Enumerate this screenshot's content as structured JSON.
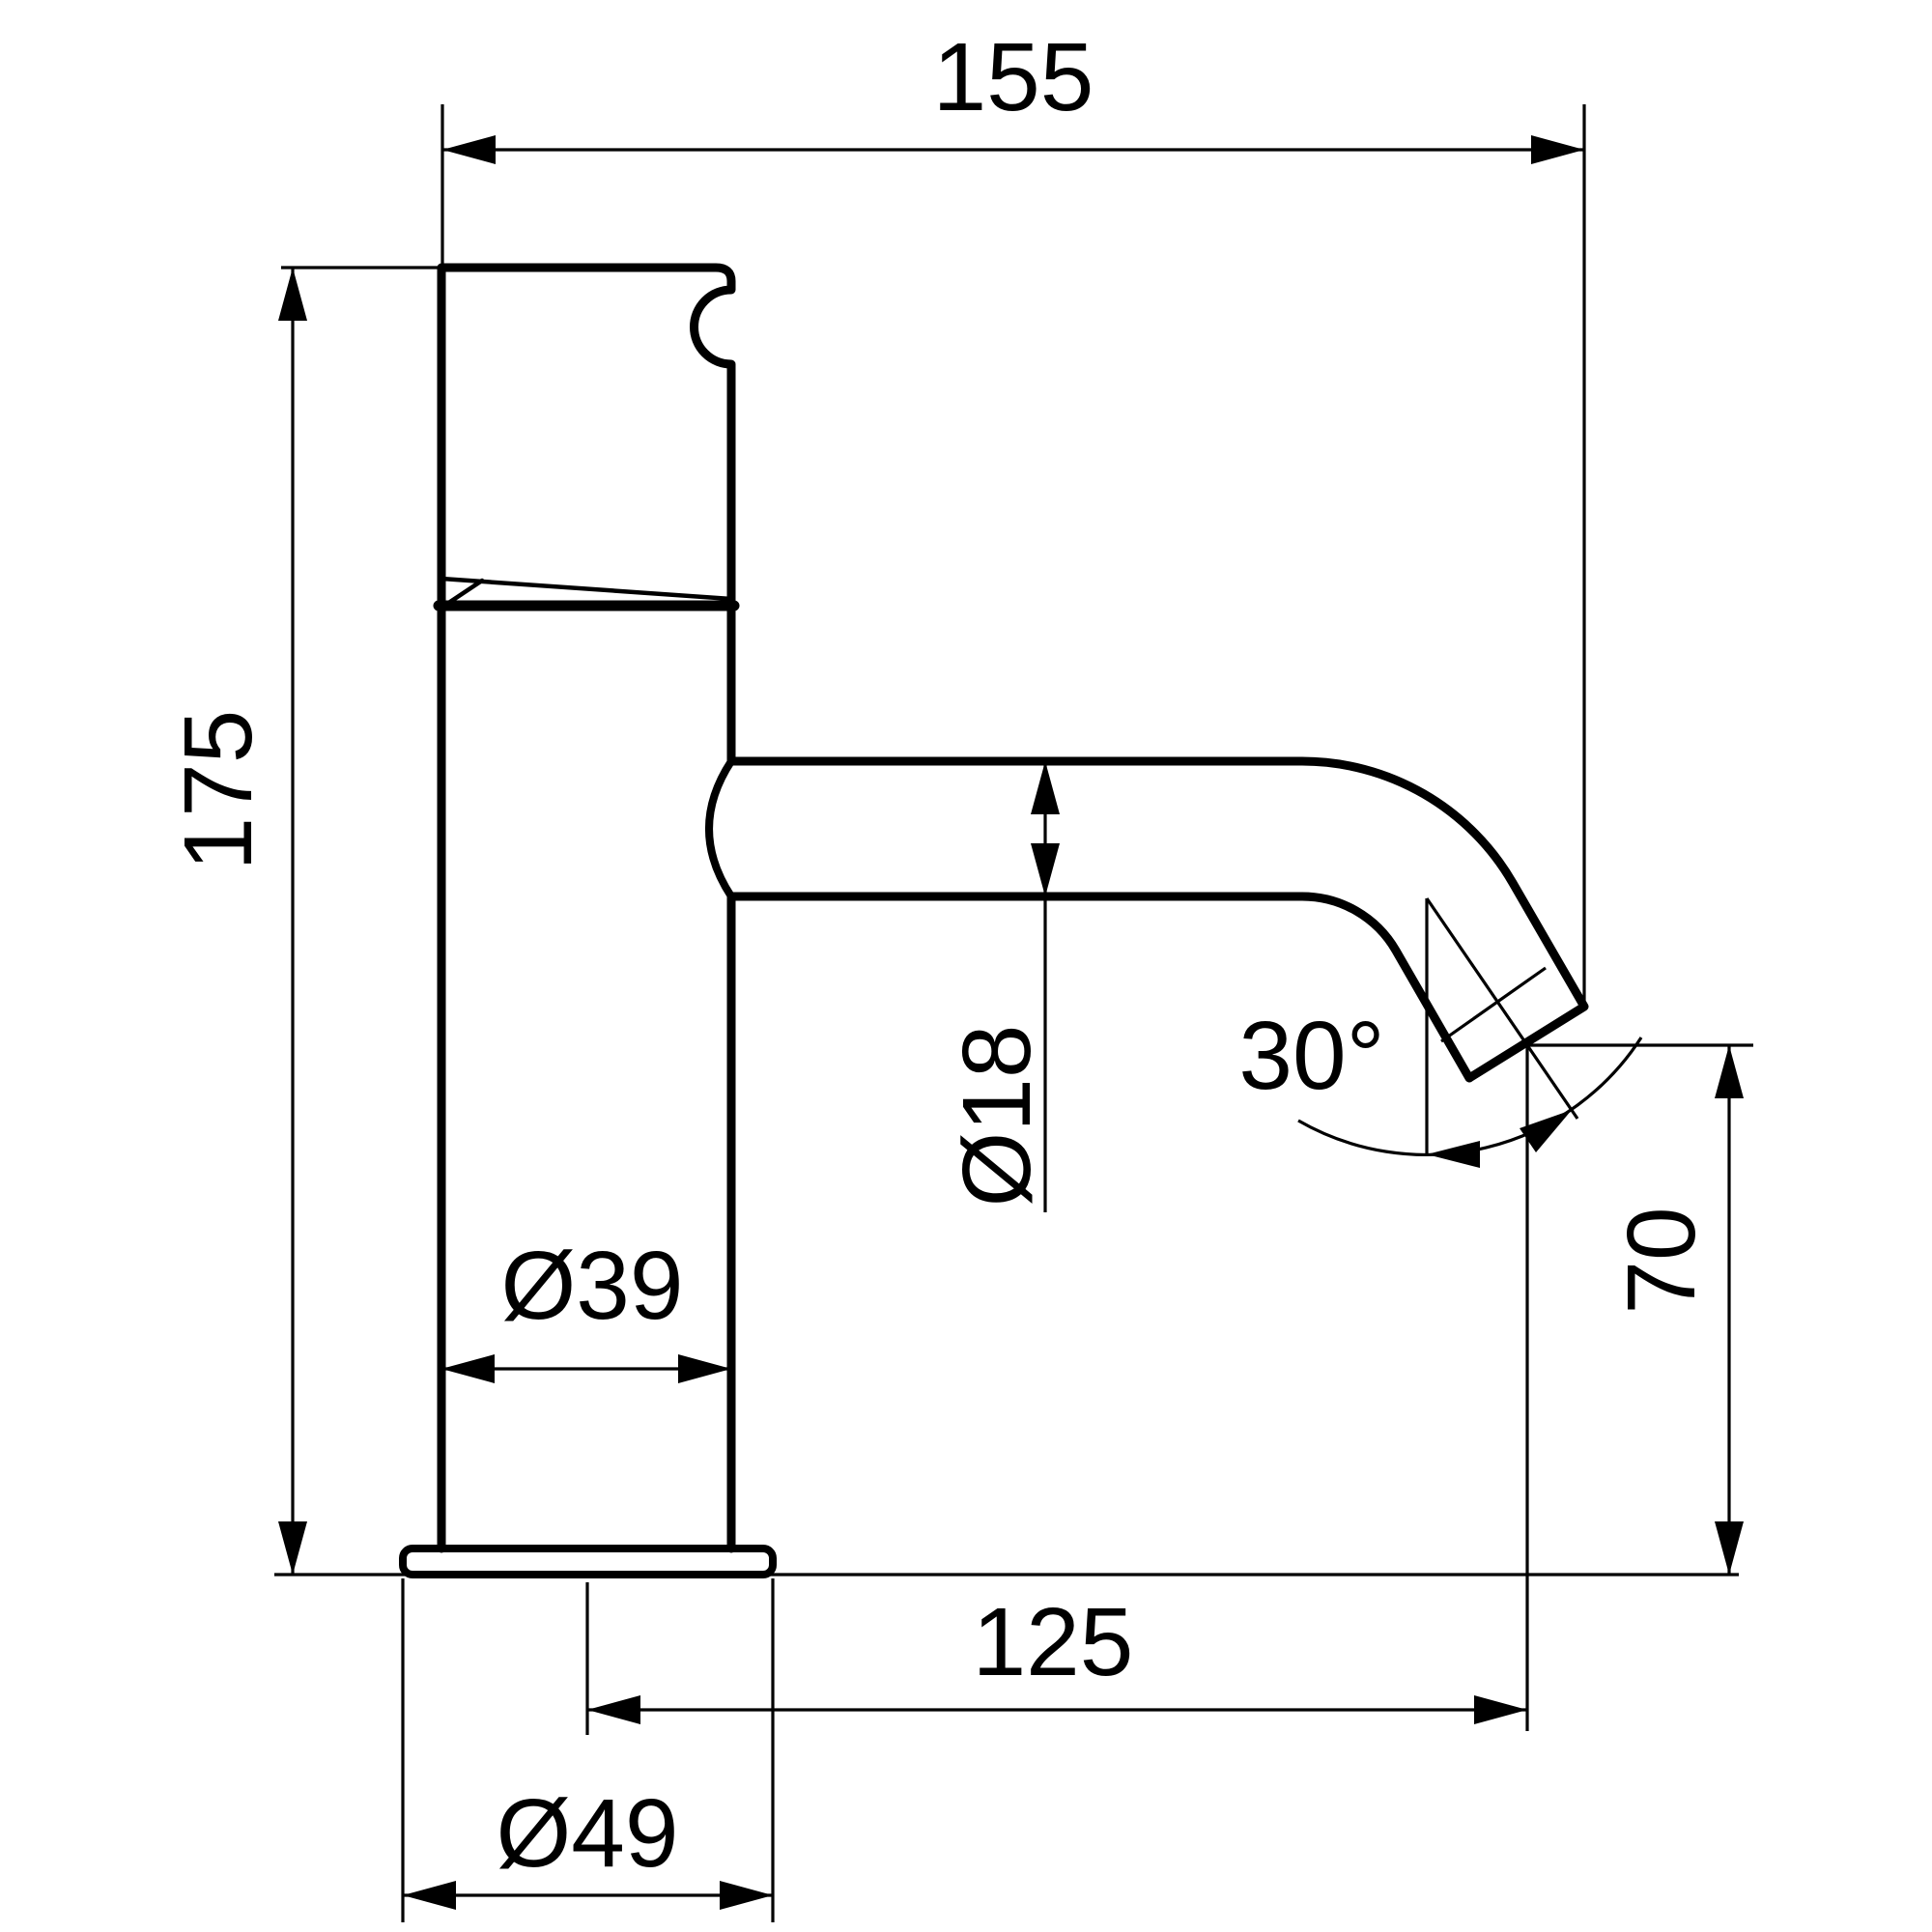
{
  "drawing": {
    "background_color": "#ffffff",
    "line_color": "#000000",
    "text_color": "#000000",
    "labels": {
      "spout_reach": "155",
      "total_height": "175",
      "spout_diameter": "Ø18",
      "spout_angle": "30°",
      "body_diameter": "Ø39",
      "outlet_height": "70",
      "spout_projection": "125",
      "base_diameter": "Ø49"
    }
  }
}
